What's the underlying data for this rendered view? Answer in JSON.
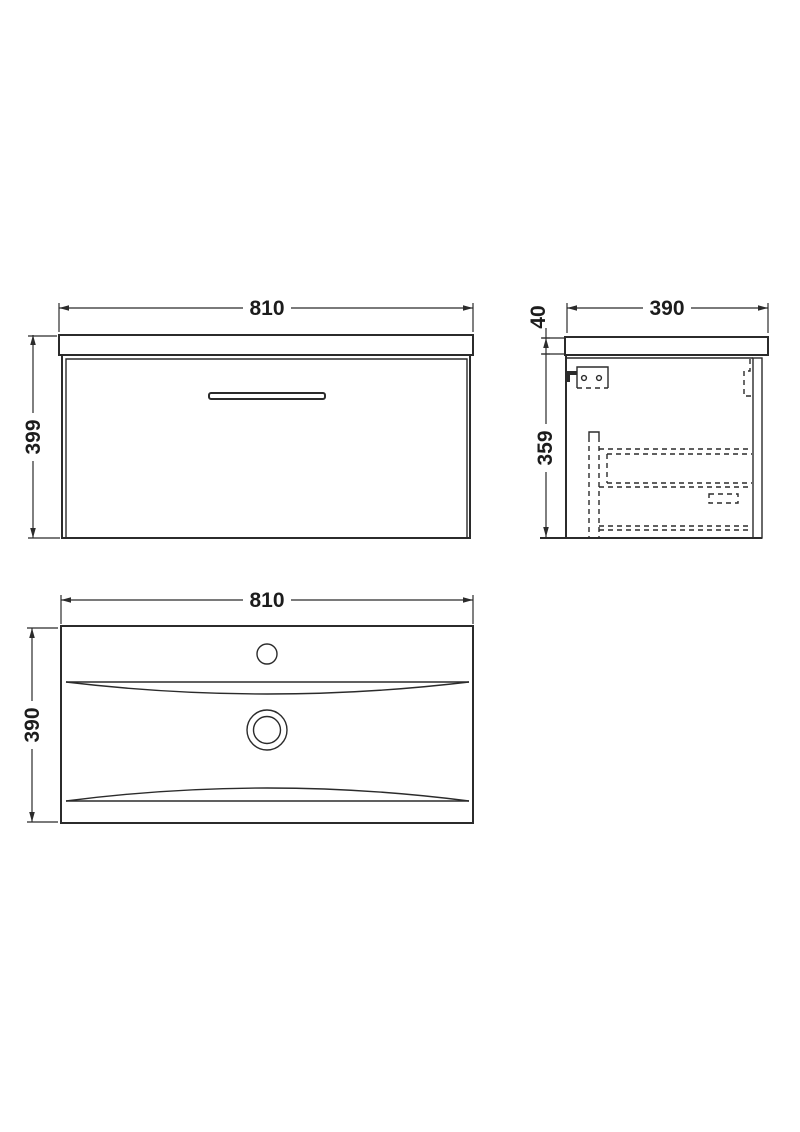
{
  "views": {
    "front": {
      "width_mm": "810",
      "height_mm": "399"
    },
    "side": {
      "depth_mm": "390",
      "worktop_thickness_mm": "40",
      "cabinet_height_mm": "359"
    },
    "plan": {
      "width_mm": "810",
      "depth_mm": "390"
    }
  },
  "colors": {
    "line": "#2b2b2b",
    "background": "#ffffff"
  }
}
